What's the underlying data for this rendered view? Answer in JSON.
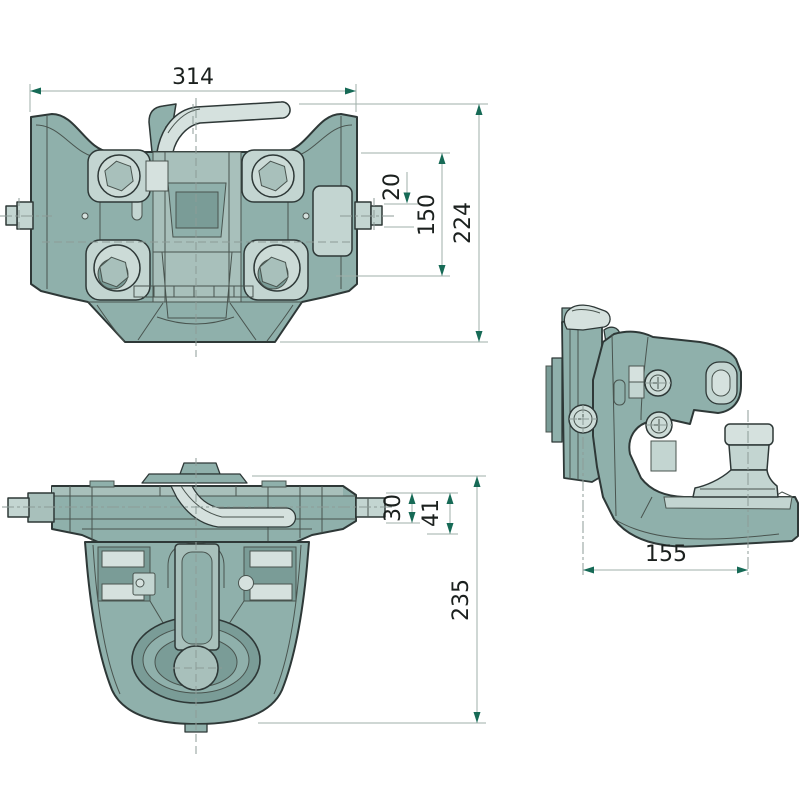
{
  "colors": {
    "background": "#ffffff",
    "body": "#8fb0ab",
    "body_light": "#a8c0bb",
    "body_dark": "#7a9c97",
    "panel": "#c3d5d1",
    "highlight": "#d5e1de",
    "bolt_face": "#ccdbd7",
    "outline": "#2e3837",
    "detail_line": "#49544f",
    "dim_line": "#9fafaa",
    "centerline": "#8c9b97",
    "arrow": "#166a56",
    "dim_text": "#1b201e"
  },
  "dimensions": {
    "front_view": {
      "overall_width": "314",
      "pin_diameter": "20",
      "flange_span": "150",
      "overall_height": "224"
    },
    "top_view": {
      "pin_diameter": "30",
      "flange_height": "41",
      "overall_depth": "235"
    },
    "side_view": {
      "mount_to_pin": "155"
    }
  }
}
